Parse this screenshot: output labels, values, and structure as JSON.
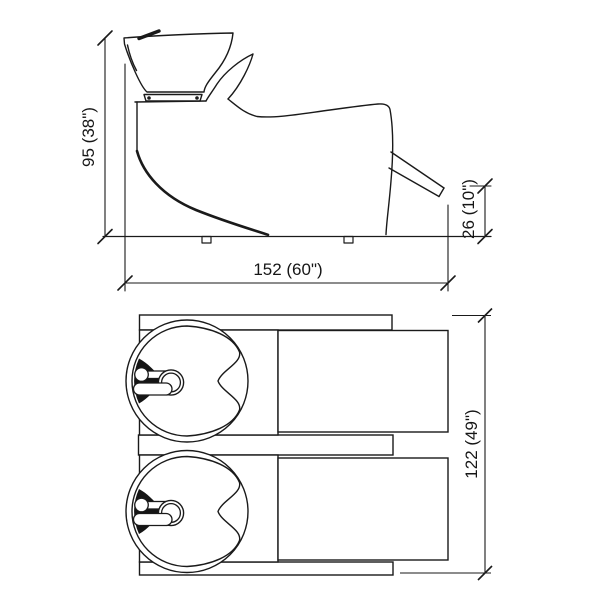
{
  "diagram": {
    "side_view": {
      "height_label": "95 (38\")",
      "width_label": "152 (60\")",
      "footrest_clearance_label": "26 (10\")"
    },
    "plan_view": {
      "depth_label": "122 (49\")"
    },
    "colors": {
      "line": "#1a1a1a",
      "background": "#ffffff"
    }
  }
}
